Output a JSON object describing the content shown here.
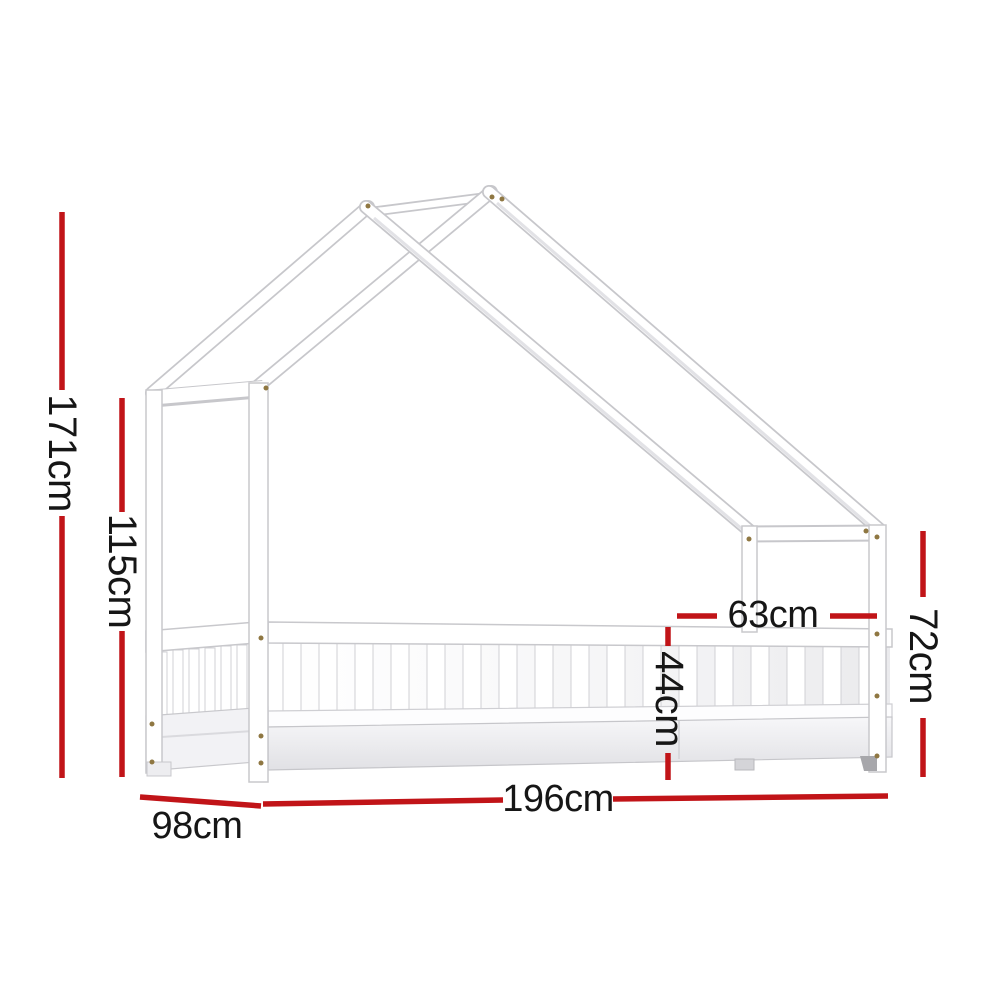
{
  "figure": {
    "background": "#ffffff"
  },
  "colors": {
    "dimension_line": "#c11418",
    "label_text": "#161616",
    "furniture_fill": "#ffffff",
    "furniture_outline": "#c8c8cc",
    "furniture_shade": "#e4e4e8",
    "screw": "#8f7742"
  },
  "dimensions": {
    "overall_height": "171cm",
    "canopy_height": "115cm",
    "bed_length": "196cm",
    "bed_width": "98cm",
    "rail_height": "44cm",
    "foot_section_width": "63cm",
    "foot_end_height": "72cm"
  }
}
